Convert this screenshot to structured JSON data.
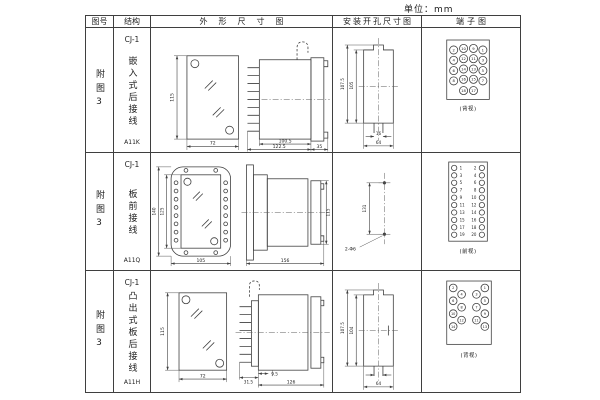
{
  "unit_label": "单位：mm",
  "header": {
    "fig_no": "图号",
    "structure": "结构",
    "outline": "外形尺寸图",
    "mounting": "安装开孔尺寸图",
    "terminal": "端子图"
  },
  "rows": [
    {
      "fig_no": "附图3",
      "model": "CJ-1",
      "structure_name": "嵌入式后接线",
      "code": "A11K",
      "outline": {
        "height": "115",
        "width": "72",
        "body_len": "100.5",
        "total_len": "122.5",
        "flange": "35"
      },
      "mounting": {
        "outer_h": "107.5",
        "inner_h": "105",
        "slot_w": "16",
        "width": "64"
      },
      "terminal": {
        "view_label": "(背视)",
        "grid": [
          [
            "2",
            "10",
            "9",
            "1"
          ],
          [
            "4",
            "12",
            "11",
            "3"
          ],
          [
            "6",
            "14",
            "13",
            "5"
          ],
          [
            "8",
            "16",
            "15",
            "7"
          ],
          [
            "18",
            "17"
          ]
        ]
      }
    },
    {
      "fig_no": "附图3",
      "model": "CJ-1",
      "structure_name": "板前接线",
      "code": "A11Q",
      "outline": {
        "outer_h": "140",
        "inner_h": "125",
        "width": "105",
        "length": "156",
        "side_h": "115"
      },
      "mounting": {
        "hole_dist": "131",
        "holes": "2-Φ6"
      },
      "terminal": {
        "view_label": "(前视)",
        "left": [
          "1",
          "3",
          "5",
          "7",
          "9",
          "11",
          "13",
          "15",
          "17",
          "19"
        ],
        "right": [
          "2",
          "4",
          "6",
          "8",
          "10",
          "12",
          "14",
          "16",
          "18",
          "20"
        ]
      }
    },
    {
      "fig_no": "附图3",
      "model": "CJ-1",
      "structure_name": "凸出式板后接线",
      "code": "A11H",
      "outline": {
        "height": "115",
        "width": "72",
        "pin_len": "31.5",
        "base": "9.5",
        "body_len": "126"
      },
      "mounting": {
        "outer_h": "107.5",
        "inner_h": "104",
        "width": "64"
      },
      "terminal": {
        "view_label": "(背视)",
        "left_outer": [
          "2",
          "6",
          "10",
          "14"
        ],
        "left_inner": [
          "4",
          "8",
          "12"
        ],
        "right_inner": [
          "3",
          "7",
          "11"
        ],
        "right_outer": [
          "1",
          "5",
          "9",
          "13"
        ]
      }
    }
  ]
}
